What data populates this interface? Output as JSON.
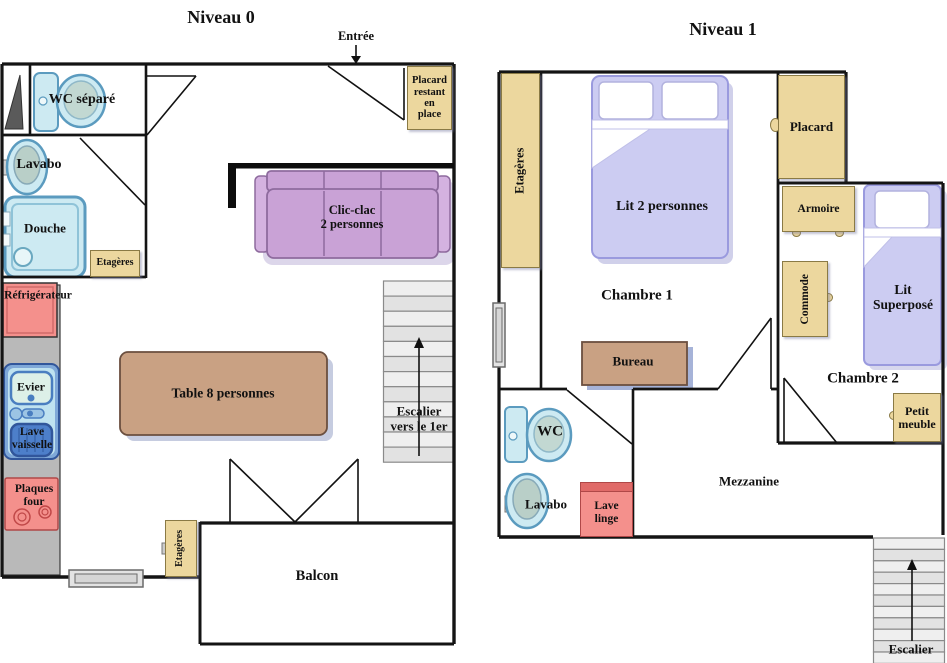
{
  "colors": {
    "wall": "#141414",
    "tan_fill": "#ecd79e",
    "tan_border": "#8a7a45",
    "fixture_blue_fill": "#cdeaf2",
    "fixture_blue_border": "#5b9bbf",
    "appliance_pink": "#f4908c",
    "sofa_purple": "#c9a2d6",
    "bed_lavender": "#ccccf2",
    "table_brown": "#c9a183",
    "counter_gray": "#b9b9b9",
    "stair_gray": "#e9e9e9",
    "shadow_blue": "#8d9cc8"
  },
  "niveau0": {
    "title": "Niveau 0",
    "entrance_label": "Entrée",
    "stairs_label": "Escalier\nvers le 1er",
    "rooms": {
      "balcon": "Balcon"
    },
    "furniture": {
      "wc_separe": "WC séparé",
      "lavabo": "Lavabo",
      "douche": "Douche",
      "etageres_sdb": "Etagères",
      "refrigerateur": "Réfrigérateur",
      "evier": "Evier",
      "lave_vaisselle": "Lave\nvaisselle",
      "plaques_four": "Plaques\nfour",
      "table": "Table 8 personnes",
      "clic_clac": "Clic-clac\n2 personnes",
      "placard_entree": "Placard\nrestant\nen\nplace",
      "etageres_balcon": "Etagères"
    }
  },
  "niveau1": {
    "title": "Niveau 1",
    "stairs_label": "Escalier",
    "rooms": {
      "chambre1": "Chambre 1",
      "chambre2": "Chambre 2",
      "mezzanine": "Mezzanine"
    },
    "furniture": {
      "etageres": "Etagères",
      "lit_2_personnes": "Lit 2 personnes",
      "placard": "Placard",
      "armoire": "Armoire",
      "commode": "Commode",
      "lit_superpose": "Lit\nSuperposé",
      "bureau": "Bureau",
      "petit_meuble": "Petit\nmeuble",
      "wc": "WC",
      "lavabo": "Lavabo",
      "lave_linge": "Lave\nlinge"
    }
  }
}
